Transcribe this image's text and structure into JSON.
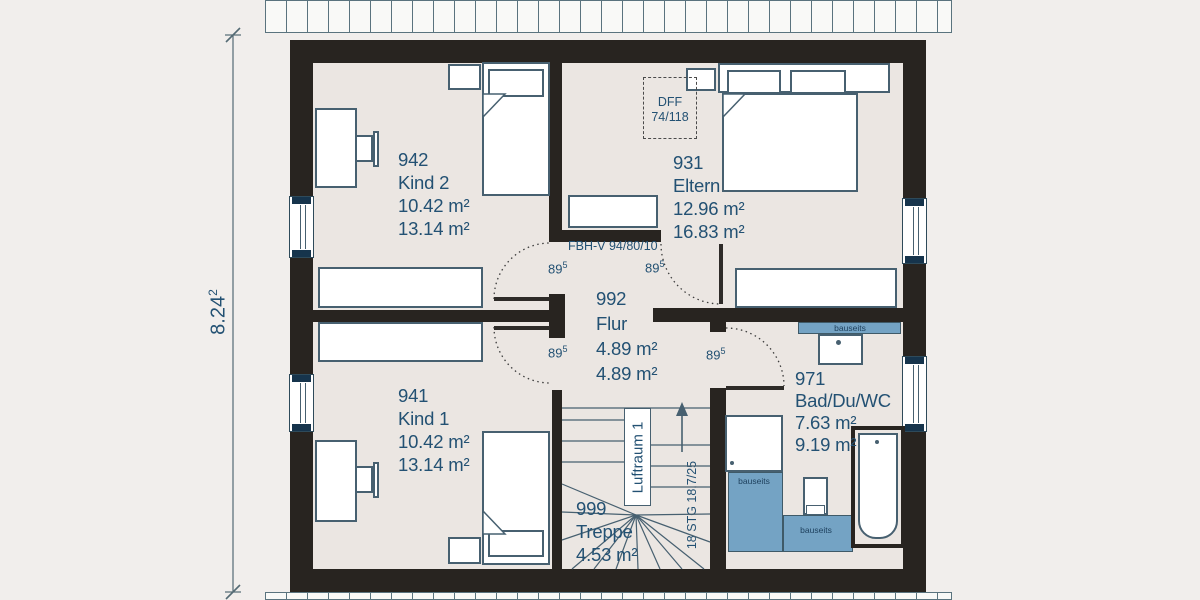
{
  "plan": {
    "rooms": [
      {
        "id": "942",
        "name": "Kind 2",
        "area1": "10.42 m²",
        "area2": "13.14 m²"
      },
      {
        "id": "931",
        "name": "Eltern",
        "area1": "12.96 m²",
        "area2": "16.83 m²"
      },
      {
        "id": "992",
        "name": "Flur",
        "area1": "4.89 m²",
        "area2": "4.89 m²"
      },
      {
        "id": "941",
        "name": "Kind 1",
        "area1": "10.42 m²",
        "area2": "13.14 m²"
      },
      {
        "id": "999",
        "name": "Treppe",
        "area1": "4.53 m²"
      },
      {
        "id": "971",
        "name": "Bad/Du/WC",
        "area1": "7.63 m²",
        "area2": "9.19 m²"
      }
    ],
    "annotations": {
      "roof_window_label": "DFF",
      "roof_window_size": "74/118",
      "floor_heating": "FBH-V 94/80/10",
      "door_width_base": "89",
      "door_width_sup": "5",
      "overall_depth_base": "8.24",
      "overall_depth_sup": "2",
      "air_space": "Luftraum 1",
      "stair_steps": "18 STG 18,7/25",
      "onsite": "bauseits"
    },
    "colors": {
      "wall": "#282420",
      "tile": "#74a3c4",
      "label": "#235173",
      "background": "#f1eeec"
    }
  }
}
